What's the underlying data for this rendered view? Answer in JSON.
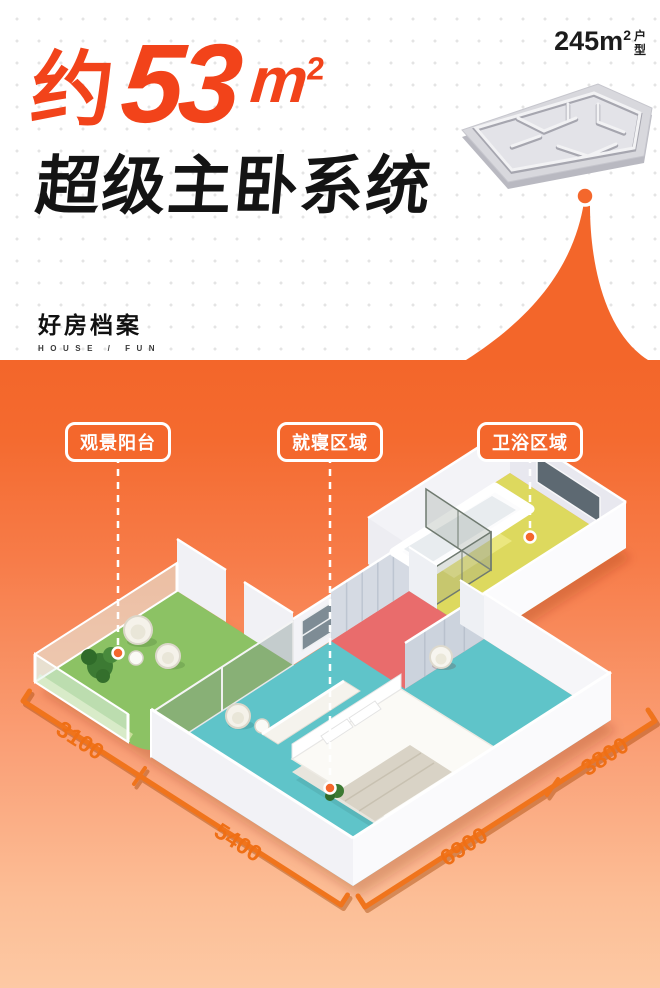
{
  "top": {
    "headline": {
      "prefix": "约",
      "number": "53",
      "unit_base": "m",
      "unit_sup": "2"
    },
    "subtitle": "超级主卧系统",
    "plan_badge": {
      "area_base": "245m",
      "area_sup": "2",
      "suffix_chars": [
        "户",
        "型"
      ]
    },
    "logo": {
      "cn": "好房档案",
      "en": "HOUSE / FUN"
    }
  },
  "floor_plan": {
    "area_labels": [
      {
        "id": "balcony",
        "text": "观景阳台"
      },
      {
        "id": "sleeping",
        "text": "就寝区域"
      },
      {
        "id": "bathroom",
        "text": "卫浴区域"
      }
    ],
    "dimensions": [
      {
        "edge": "balcony-left",
        "value": "3100"
      },
      {
        "edge": "bedroom-left",
        "value": "5400"
      },
      {
        "edge": "bedroom-right",
        "value": "6900"
      },
      {
        "edge": "bathroom-right",
        "value": "3800"
      }
    ],
    "room_colors": {
      "balcony": "#8cc264",
      "bedroom": "#5fc4c9",
      "closet": "#e96c6c",
      "bathroom": "#ddd95e"
    }
  },
  "colors": {
    "accent_orange": "#f4672c",
    "headline_orange": "#f2431a",
    "gradient_bottom": "#fdc9a4",
    "dimension_orange": "#f0741c"
  }
}
